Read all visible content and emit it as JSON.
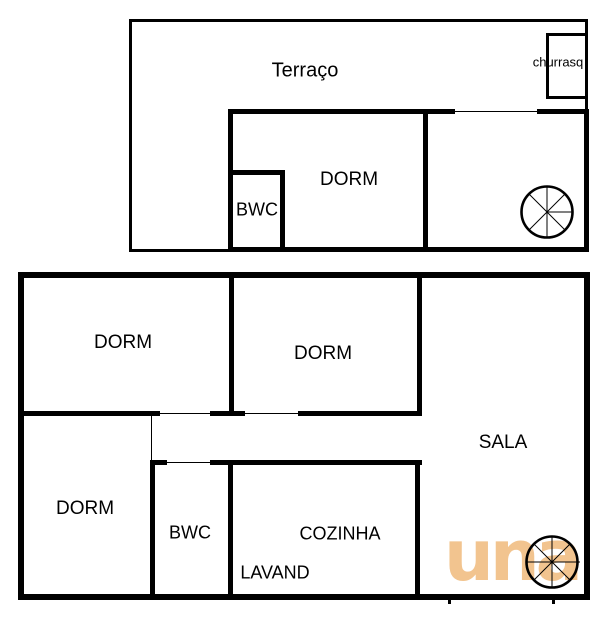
{
  "title": "two-storey floor plan",
  "upper_floor": {
    "terrace_label": "Terraço",
    "churrasq_label": "churrasq",
    "dorm_label": "DORM",
    "bwc_label": "BWC",
    "staircase_icon": "spiral-staircase"
  },
  "lower_floor": {
    "dorm_top_left_label": "DORM",
    "dorm_top_middle_label": "DORM",
    "dorm_bottom_left_label": "DORM",
    "sala_label": "SALA",
    "bwc_label": "BWC",
    "cozinha_label": "COZINHA",
    "lavand_label": "LAVAND",
    "staircase_icon": "spiral-staircase"
  },
  "watermark": {
    "text": "una",
    "color": "#F2C48F"
  },
  "colors": {
    "wall": "#000000",
    "background": "#FFFFFF",
    "text": "#000000"
  }
}
